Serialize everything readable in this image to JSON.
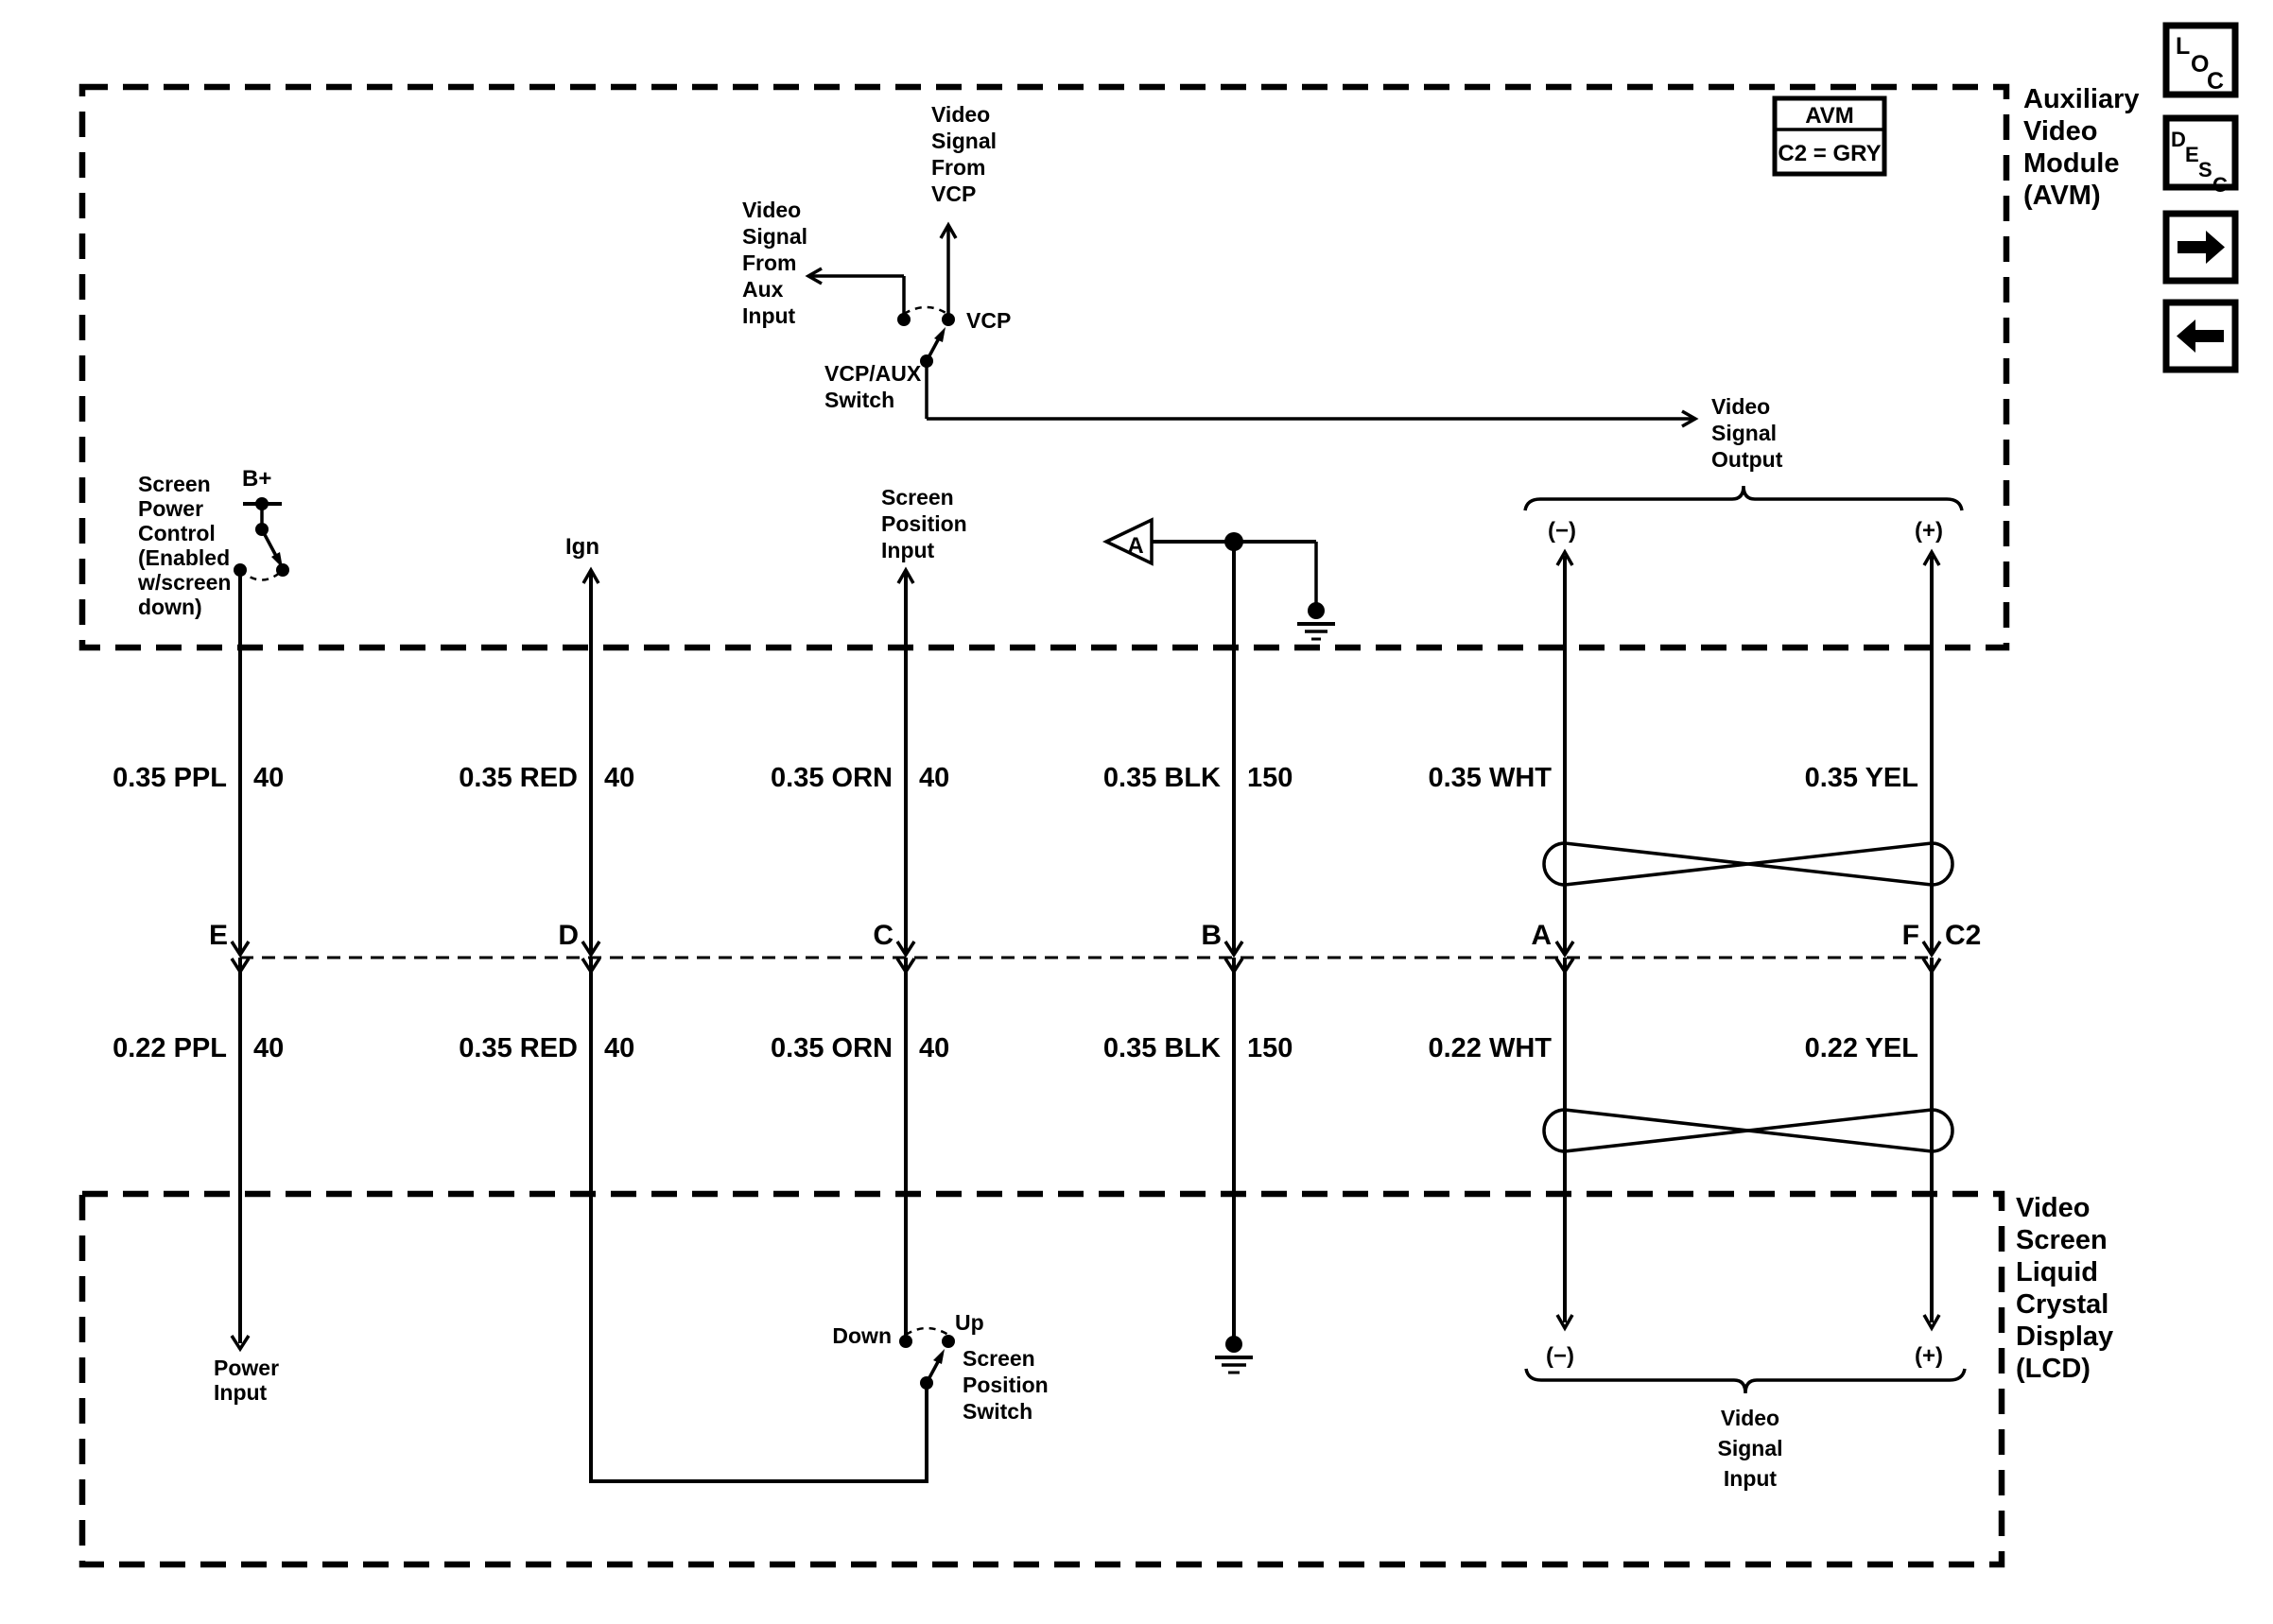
{
  "nav": {
    "loc_letters": [
      "L",
      "O",
      "C"
    ],
    "desc_letters": [
      "D",
      "E",
      "S",
      "C"
    ],
    "next_icon": "right-arrow",
    "prev_icon": "left-arrow"
  },
  "avm": {
    "name_lines": [
      "Auxiliary",
      "Video",
      "Module",
      "(AVM)"
    ],
    "tag": {
      "name": "AVM",
      "connector": "C2 = GRY"
    },
    "video_signal_from_vcp_lines": [
      "Video",
      "Signal",
      "From",
      "VCP"
    ],
    "video_signal_from_aux_lines": [
      "Video",
      "Signal",
      "From",
      "Aux",
      "Input"
    ],
    "vcp_label": "VCP",
    "vcp_aux_switch_lines": [
      "VCP/AUX",
      "Switch"
    ],
    "video_signal_output_lines": [
      "Video",
      "Signal",
      "Output"
    ],
    "screen_power_control_lines": [
      "Screen",
      "Power",
      "Control",
      "(Enabled",
      "w/screen",
      "down)"
    ],
    "b_plus_label": "B+",
    "ign_label": "Ign",
    "screen_position_input_lines": [
      "Screen",
      "Position",
      "Input"
    ],
    "ground_triangle_label": "A",
    "output_minus": "(−)",
    "output_plus": "(+)"
  },
  "harness": {
    "upper_wires": [
      {
        "gauge_color": "0.35 PPL",
        "circuit": "40"
      },
      {
        "gauge_color": "0.35 RED",
        "circuit": "40"
      },
      {
        "gauge_color": "0.35 ORN",
        "circuit": "40"
      },
      {
        "gauge_color": "0.35 BLK",
        "circuit": "150"
      },
      {
        "gauge_color": "0.35 WHT"
      },
      {
        "gauge_color": "0.35 YEL"
      }
    ],
    "pins": [
      "E",
      "D",
      "C",
      "B",
      "A",
      "F"
    ],
    "connector_label": "C2",
    "lower_wires": [
      {
        "gauge_color": "0.22 PPL",
        "circuit": "40"
      },
      {
        "gauge_color": "0.35 RED",
        "circuit": "40"
      },
      {
        "gauge_color": "0.35 ORN",
        "circuit": "40"
      },
      {
        "gauge_color": "0.35 BLK",
        "circuit": "150"
      },
      {
        "gauge_color": "0.22 WHT"
      },
      {
        "gauge_color": "0.22 YEL"
      }
    ]
  },
  "lcd": {
    "name_lines": [
      "Video",
      "Screen",
      "Liquid",
      "Crystal",
      "Display",
      "(LCD)"
    ],
    "power_input_lines": [
      "Power",
      "Input"
    ],
    "down_label": "Down",
    "up_label": "Up",
    "screen_position_switch_lines": [
      "Screen",
      "Position",
      "Switch"
    ],
    "input_minus": "(−)",
    "input_plus": "(+)",
    "video_signal_input_lines": [
      "Video",
      "Signal",
      "Input"
    ]
  },
  "colors": {
    "ink": "#000000",
    "paper": "#ffffff"
  }
}
